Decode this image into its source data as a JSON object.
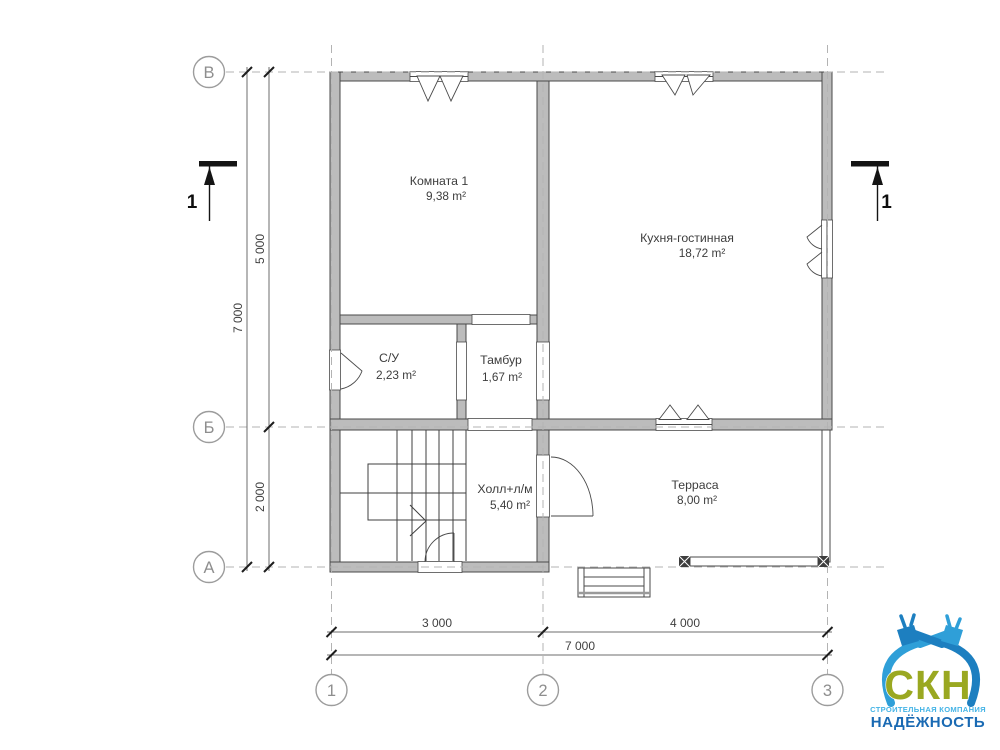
{
  "drawing": {
    "rooms": [
      {
        "name": "Комната 1",
        "area": "9,38 m²"
      },
      {
        "name": "Кухня-гостинная",
        "area": "18,72 m²"
      },
      {
        "name": "С/У",
        "area": "2,23 m²"
      },
      {
        "name": "Тамбур",
        "area": "1,67 m²"
      },
      {
        "name": "Холл+л/м",
        "area": "5,40 m²"
      },
      {
        "name": "Терраса",
        "area": "8,00 m²"
      }
    ],
    "axes": {
      "rows": [
        "В",
        "Б",
        "А"
      ],
      "cols": [
        "1",
        "2",
        "3"
      ]
    },
    "dims": {
      "left_total": "7 000",
      "left_upper": "5 000",
      "left_lower": "2 000",
      "bottom_left": "3 000",
      "bottom_right": "4 000",
      "bottom_total": "7 000"
    },
    "section": {
      "label": "1"
    },
    "colors": {
      "wall_fill": "#bcbcbc",
      "line": "#4a4a4a",
      "dash": "#b3b3b3"
    },
    "logo": {
      "abbr": "СКН",
      "line1": "СТРОИТЕЛЬНАЯ КОМПАНИЯ",
      "line2": "НАДЁЖНОСТЬ",
      "colors": {
        "abbr": "#9aa821",
        "line1": "#45b4e6",
        "line2": "#1a6ab3",
        "tool_light": "#2f9fd8",
        "tool_dark": "#1d7fc0"
      }
    }
  }
}
